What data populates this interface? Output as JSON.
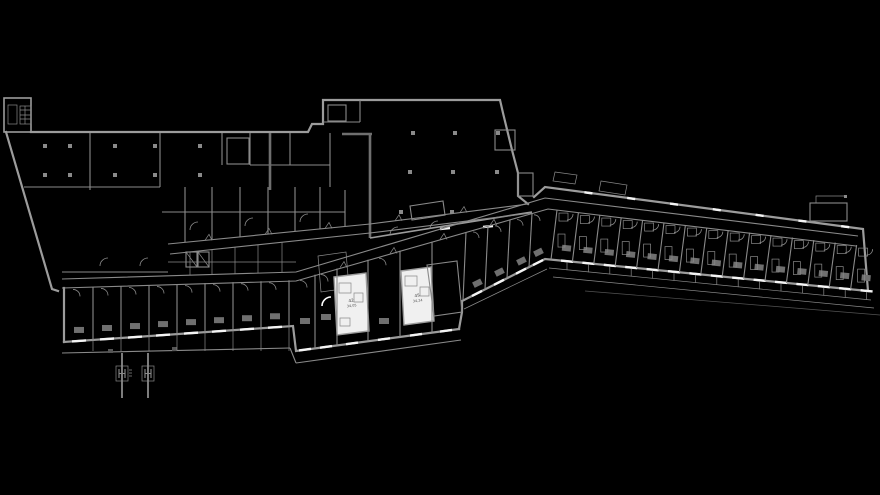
{
  "drawing": {
    "type": "architectural-floor-plan",
    "description": "CAD floor plan, gray linework on black"
  },
  "colors": {
    "background": "#000000",
    "wall": "#9c9c9c",
    "wall_dim": "#8a8a8a",
    "wall_dark": "#6f6f6f",
    "window": "#f4f4f4",
    "room_fill": "#f0f0f0",
    "label": "#4a4a4a"
  },
  "rooms": {
    "room_a": {
      "number": "42",
      "area": "34,05"
    },
    "room_b": {
      "number": "45",
      "area": "34,24"
    }
  },
  "markers": {
    "left_glyph": "H",
    "right_glyph": "H"
  }
}
